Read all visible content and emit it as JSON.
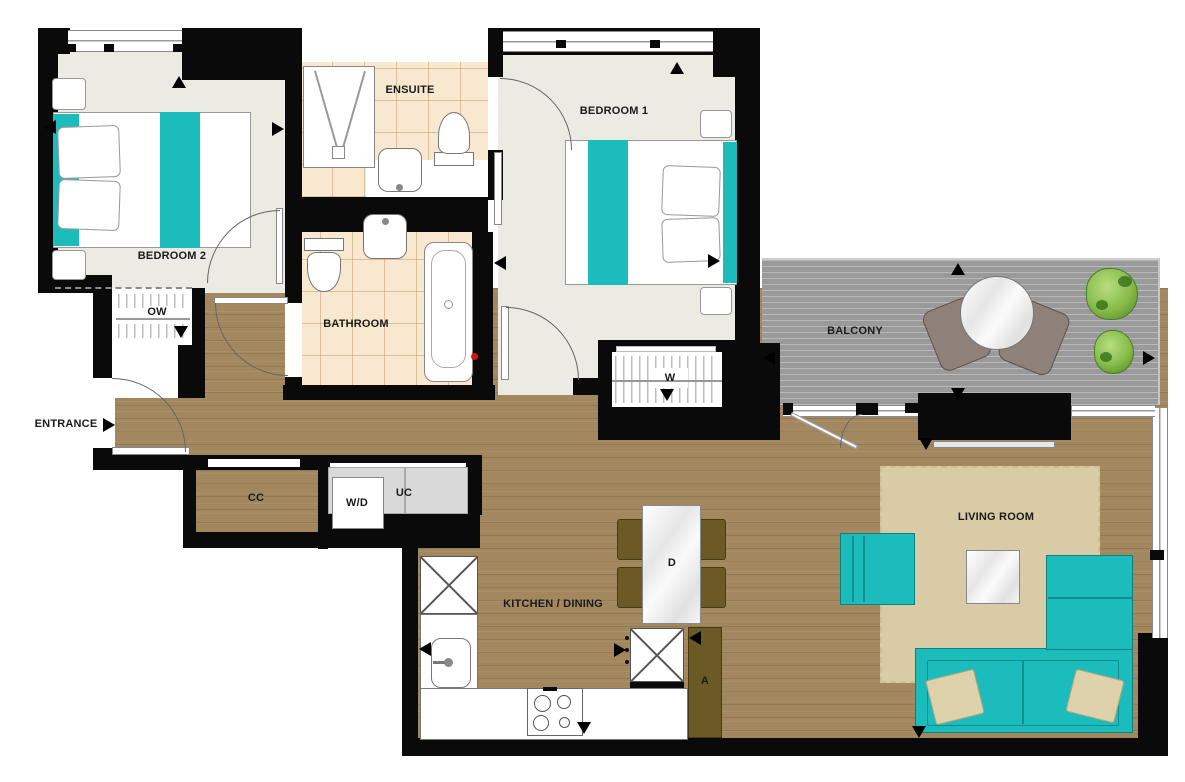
{
  "floorplan": {
    "rooms": {
      "bedroom1": "BEDROOM 1",
      "bedroom2": "BEDROOM 2",
      "ensuite": "ENSUITE",
      "bathroom": "BATHROOM",
      "balcony": "BALCONY",
      "kitchen_dining": "KITCHEN / DINING",
      "living_room": "LIVING ROOM",
      "entrance": "ENTRANCE"
    },
    "storage": {
      "ow": "OW",
      "cc": "CC",
      "w": "W",
      "uc": "UC"
    },
    "fixtures": {
      "washer_dryer": "W/D",
      "dining_table": "D",
      "appliance_cupboard": "A"
    },
    "colors": {
      "wall": "#0a0a0a",
      "accent_teal": "#1dbcbc",
      "wood_floor": "#a2875f",
      "tile_floor": "#f7e8cf",
      "room_floor": "#ebeae3",
      "balcony_deck": "#9a9a9a",
      "rug": "#d8cba6",
      "olive_furniture": "#6b5a25",
      "plant_green": "#86bb49",
      "marker_red": "#e01010"
    }
  }
}
